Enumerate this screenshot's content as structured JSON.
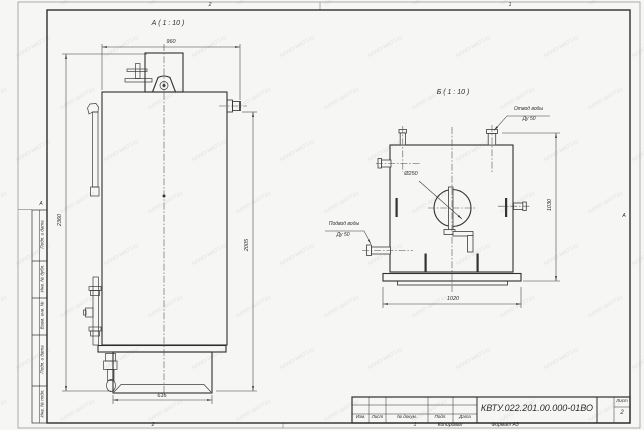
{
  "sheet": {
    "watermark_text": "NANO-WATT.kz",
    "zone_marks": {
      "top_left": "2",
      "top_right": "1",
      "bottom_left": "2",
      "bottom_right": "1",
      "left_middle": "А",
      "right_middle": "А"
    }
  },
  "side_column": {
    "labels": [
      "Подп. и дата",
      "Инв. № дубл.",
      "Взам. инв. №",
      "Подп. и дата",
      "Инв. № подл."
    ]
  },
  "view_a": {
    "label": "А ( 1 : 10 )",
    "dim_width_top": "960",
    "dim_height_overall": "2360",
    "dim_height_right": "2005",
    "dim_base_width": "615"
  },
  "view_b": {
    "label": "Б ( 1 : 10 )",
    "dim_diameter": "Ø250",
    "dim_height_right": "1030",
    "dim_width_bottom": "1020",
    "callout_outlet_line1": "Отвод воды",
    "callout_outlet_line2": "Ду 50",
    "callout_inlet_line1": "Подвод воды",
    "callout_inlet_line2": "Ду 50"
  },
  "title_block": {
    "doc_number": "КВТУ.022.201.00.000-01ВО",
    "col_izm": "Изм.",
    "col_list": "Лист",
    "col_ndoc": "№ докум.",
    "col_podp": "Подп.",
    "col_data": "Дата",
    "sheet_label": "Лист",
    "sheet_number": "2",
    "footer_copied": "Копировал",
    "footer_format": "Формат А3"
  }
}
